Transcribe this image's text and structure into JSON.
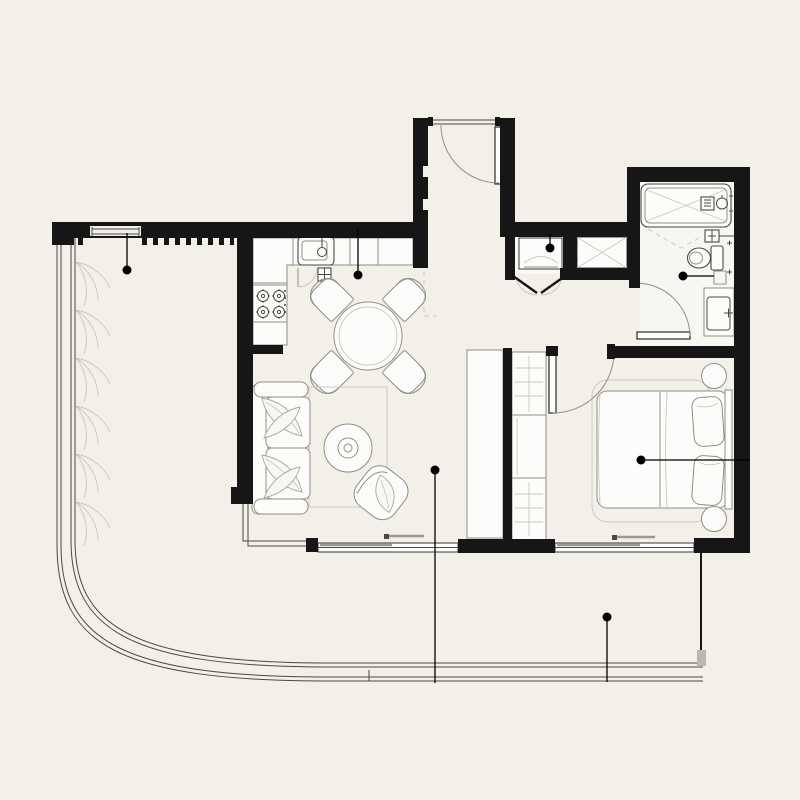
{
  "theme": {
    "background": "#f2f0e8",
    "wall": "#161616",
    "line_strong": "#4a4944",
    "line_medium": "#8f8e88",
    "line_light": "#c8c7bf",
    "fixture_fill": "#fcfcfa",
    "marker": "#000000"
  },
  "floorplan": {
    "kind": "apartment-floor-plan",
    "rooms": [
      {
        "name": "balcony"
      },
      {
        "name": "kitchen"
      },
      {
        "name": "dining-area"
      },
      {
        "name": "living-room"
      },
      {
        "name": "entry-hall"
      },
      {
        "name": "utility-closet"
      },
      {
        "name": "ventilation-shaft"
      },
      {
        "name": "bathroom"
      },
      {
        "name": "bedroom"
      },
      {
        "name": "terrace"
      }
    ],
    "fixtures": [
      "kitchen-sink",
      "cooktop",
      "dishwasher",
      "dining-table",
      "dining-chair",
      "sofa",
      "coffee-table",
      "accent-chair",
      "area-rug",
      "tv-cabinet",
      "wardrobe",
      "double-bed",
      "pillow",
      "nightstand",
      "bathtub",
      "toilet",
      "washbasin",
      "washing-machine",
      "entry-door",
      "bathroom-door",
      "bedroom-door",
      "bifold-doors",
      "balcony-glazing",
      "terrace-railing",
      "window-wall"
    ],
    "markers": [
      {
        "id": "balcony-marker",
        "x": 127,
        "y": 270,
        "to_x": 127,
        "to_y": 233
      },
      {
        "id": "kitchen-marker",
        "x": 358,
        "y": 275,
        "to_x": 358,
        "to_y": 229
      },
      {
        "id": "utility-marker",
        "x": 550,
        "y": 248,
        "to_x": 550,
        "to_y": 234
      },
      {
        "id": "bathroom-marker",
        "x": 683,
        "y": 276,
        "to_x": 714,
        "to_y": 276
      },
      {
        "id": "bedroom-marker",
        "x": 641,
        "y": 460,
        "to_x": 750,
        "to_y": 460
      },
      {
        "id": "living-marker",
        "x": 435,
        "y": 470,
        "to_x": 435,
        "to_y": 683
      },
      {
        "id": "terrace-marker",
        "x": 607,
        "y": 617,
        "to_x": 607,
        "to_y": 682
      }
    ]
  }
}
